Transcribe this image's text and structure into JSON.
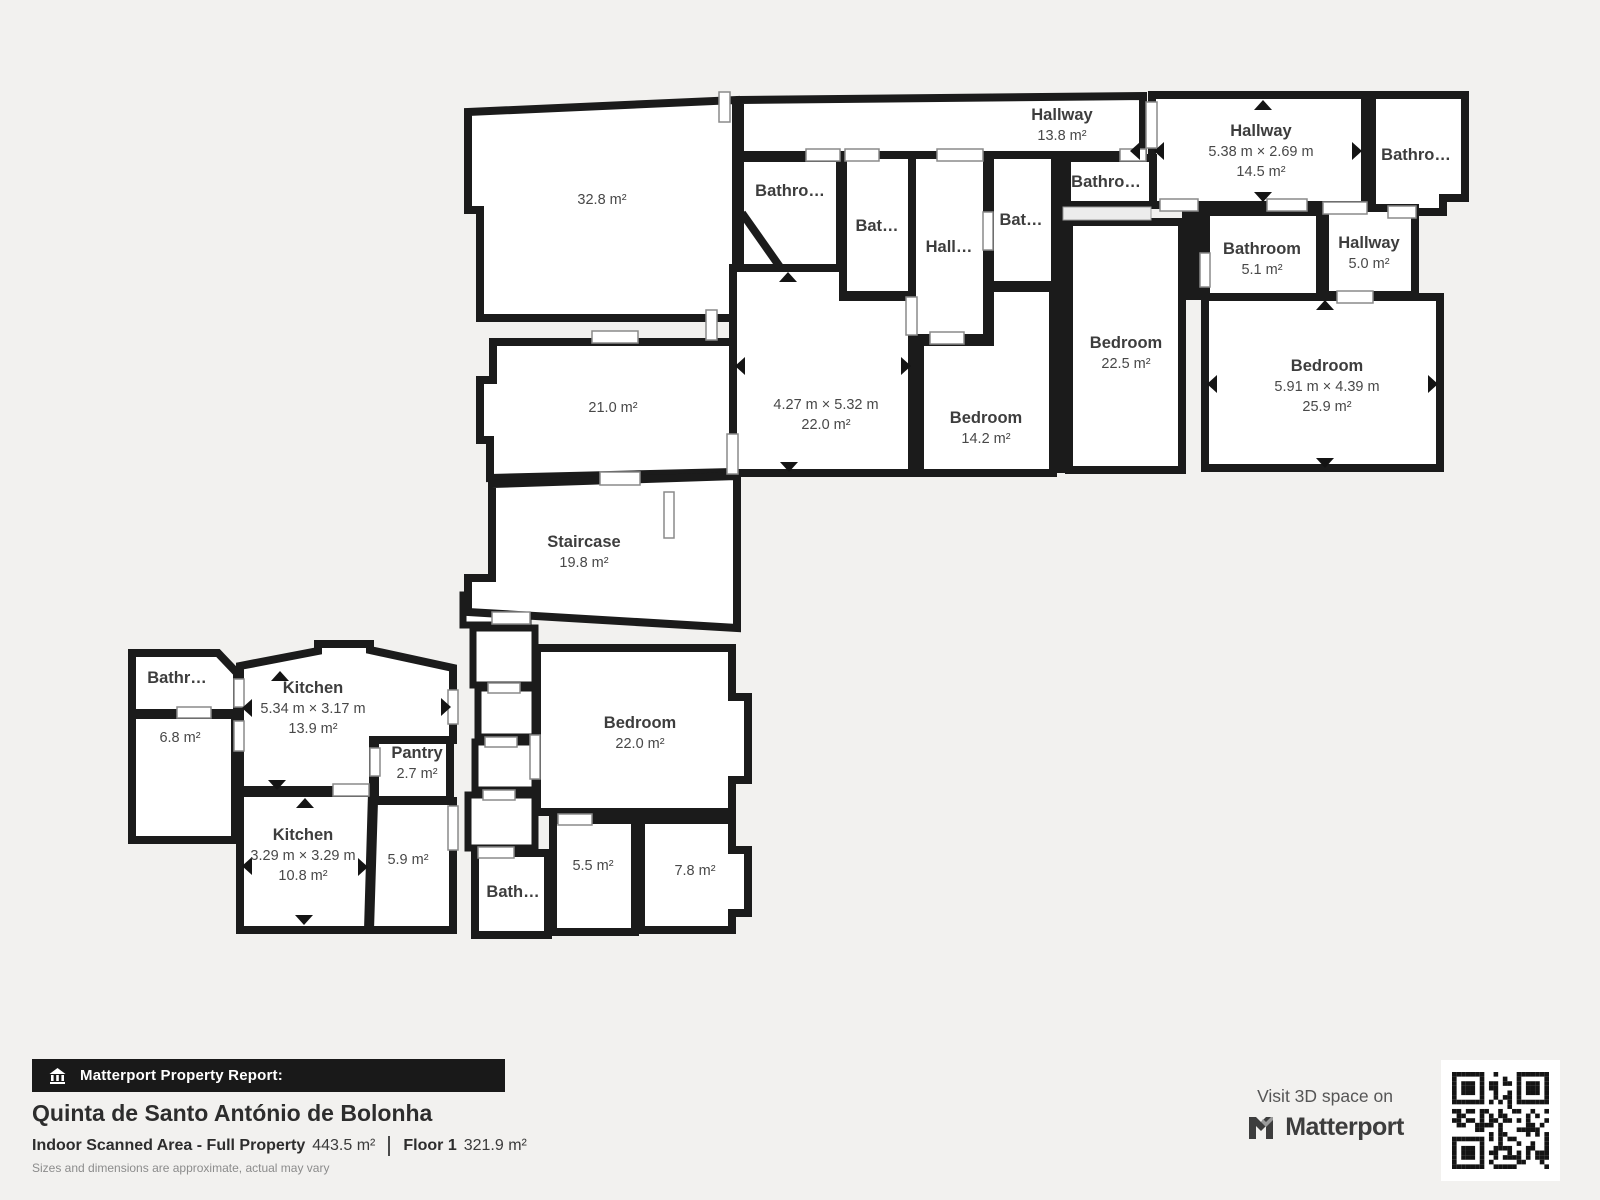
{
  "background": "#f2f1ef",
  "wall_color": "#1b1b1b",
  "rooms": [
    {
      "id": "hallway-top",
      "name": "Hallway",
      "area": "13.8 m²"
    },
    {
      "id": "hallway-right",
      "name": "Hallway",
      "dims": "5.38 m × 2.69 m",
      "area": "14.5 m²"
    },
    {
      "id": "bathroom-top-right",
      "name": "Bathro…"
    },
    {
      "id": "bathroom-a",
      "name": "Bathro…"
    },
    {
      "id": "bathroom-b",
      "name": "Bat…"
    },
    {
      "id": "hallway-mid",
      "name": "Hall…"
    },
    {
      "id": "bathroom-c",
      "name": "Bat…"
    },
    {
      "id": "bathroom-d",
      "name": "Bathro…"
    },
    {
      "id": "bathroom-5-1",
      "name": "Bathroom",
      "area": "5.1 m²"
    },
    {
      "id": "hallway-5-0",
      "name": "Hallway",
      "area": "5.0 m²"
    },
    {
      "id": "room-32-8",
      "area": "32.8 m²"
    },
    {
      "id": "room-21-0",
      "area": "21.0 m²"
    },
    {
      "id": "room-22-0",
      "dims": "4.27 m × 5.32 m",
      "area": "22.0 m²"
    },
    {
      "id": "bedroom-14-2",
      "name": "Bedroom",
      "area": "14.2 m²"
    },
    {
      "id": "bedroom-22-5",
      "name": "Bedroom",
      "area": "22.5 m²"
    },
    {
      "id": "bedroom-25-9",
      "name": "Bedroom",
      "dims": "5.91 m × 4.39 m",
      "area": "25.9 m²"
    },
    {
      "id": "staircase",
      "name": "Staircase",
      "area": "19.8 m²"
    },
    {
      "id": "bathroom-f",
      "name": "Bathr…"
    },
    {
      "id": "room-6-8",
      "area": "6.8 m²"
    },
    {
      "id": "kitchen-13-9",
      "name": "Kitchen",
      "dims": "5.34 m × 3.17 m",
      "area": "13.9 m²"
    },
    {
      "id": "pantry",
      "name": "Pantry",
      "area": "2.7 m²"
    },
    {
      "id": "kitchen-10-8",
      "name": "Kitchen",
      "dims": "3.29 m × 3.29 m",
      "area": "10.8 m²"
    },
    {
      "id": "room-5-9",
      "area": "5.9 m²"
    },
    {
      "id": "bedroom-22-0",
      "name": "Bedroom",
      "area": "22.0 m²"
    },
    {
      "id": "bathroom-g",
      "name": "Bath…"
    },
    {
      "id": "room-5-5",
      "area": "5.5 m²"
    },
    {
      "id": "room-7-8",
      "area": "7.8 m²"
    }
  ],
  "footer": {
    "report_label": "Matterport Property Report:",
    "property_name": "Quinta de Santo António de Bolonha",
    "scanned_area_label": "Indoor Scanned Area - Full Property",
    "scanned_area_value": "443.5 m²",
    "floor_label": "Floor 1",
    "floor_value": "321.9 m²",
    "disclaimer": "Sizes and dimensions are approximate, actual may vary",
    "visit_label": "Visit 3D space on",
    "brand": "Matterport"
  }
}
